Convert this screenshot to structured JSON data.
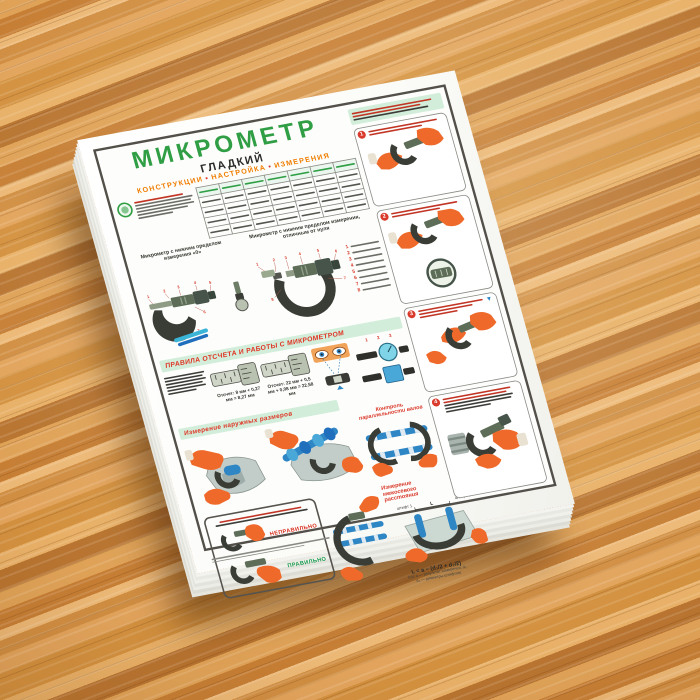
{
  "poster": {
    "title": "МИКРОМЕТР",
    "title_secondary": "ГЛАДКИЙ",
    "subtitle_parts": [
      "КОНСТРУКЦИИ",
      "НАСТРОЙКА",
      "ИЗМЕРЕНИЯ"
    ],
    "subtitle_separator": "•",
    "captions": {
      "mic_zero": "Микрометр с нижним пределом измерения «0»",
      "mic_nonzero": "Микрометр с нижним пределом измерения, отличным от нуля",
      "rules_banner": "ПРАВИЛА ОТСЧЕТА И РАБОТЫ С МИКРОМЕТРОМ",
      "outer_banner": "Измерение наружных размеров",
      "parallel": "Контроль параллельности валов",
      "axis_distance": "Измерение межосевого расстояния",
      "reading_left": "Отсчет: 8 мм + 0,27 мм = 8,27 мм",
      "reading_right": "Отсчет: 22 мм + 0,5 мм + 0,08 мм = 22,58 мм",
      "label_wrong": "НЕПРАВИЛЬНО",
      "label_right": "ПРАВИЛЬНО",
      "formula": "L = a − (d₁/2 + d₂/2)",
      "formula_note": "(где a — результат измерения; d₁, d₂ — диаметры штифтов)",
      "dim_label": "L",
      "pin_left": "штифт 1",
      "pin_right": "штифт 2"
    },
    "panels": [
      {
        "num": "1"
      },
      {
        "num": "2"
      },
      {
        "num": "3"
      },
      {
        "num": "4"
      }
    ],
    "callouts_a": [
      "1",
      "2",
      "3",
      "4",
      "5",
      "6",
      "7"
    ],
    "callouts_b": [
      "1",
      "2",
      "3",
      "4",
      "5",
      "6",
      "7",
      "8"
    ],
    "legend_nums": [
      "1",
      "2",
      "3",
      "4",
      "5",
      "6",
      "7",
      "8"
    ],
    "strip_callouts": [
      "1",
      "2",
      "3"
    ],
    "colors": {
      "accent_green": "#2f9e44",
      "accent_orange": "#ef7d00",
      "accent_red": "#d93a2b",
      "banner_bg": "#d2eeda",
      "glove_orange": "#ef6a2a",
      "micrometer_dark": "#3a3d36",
      "micrometer_green": "#5d6d57",
      "detail_blue": "#2e86c5",
      "wood": "#d08e42"
    }
  }
}
